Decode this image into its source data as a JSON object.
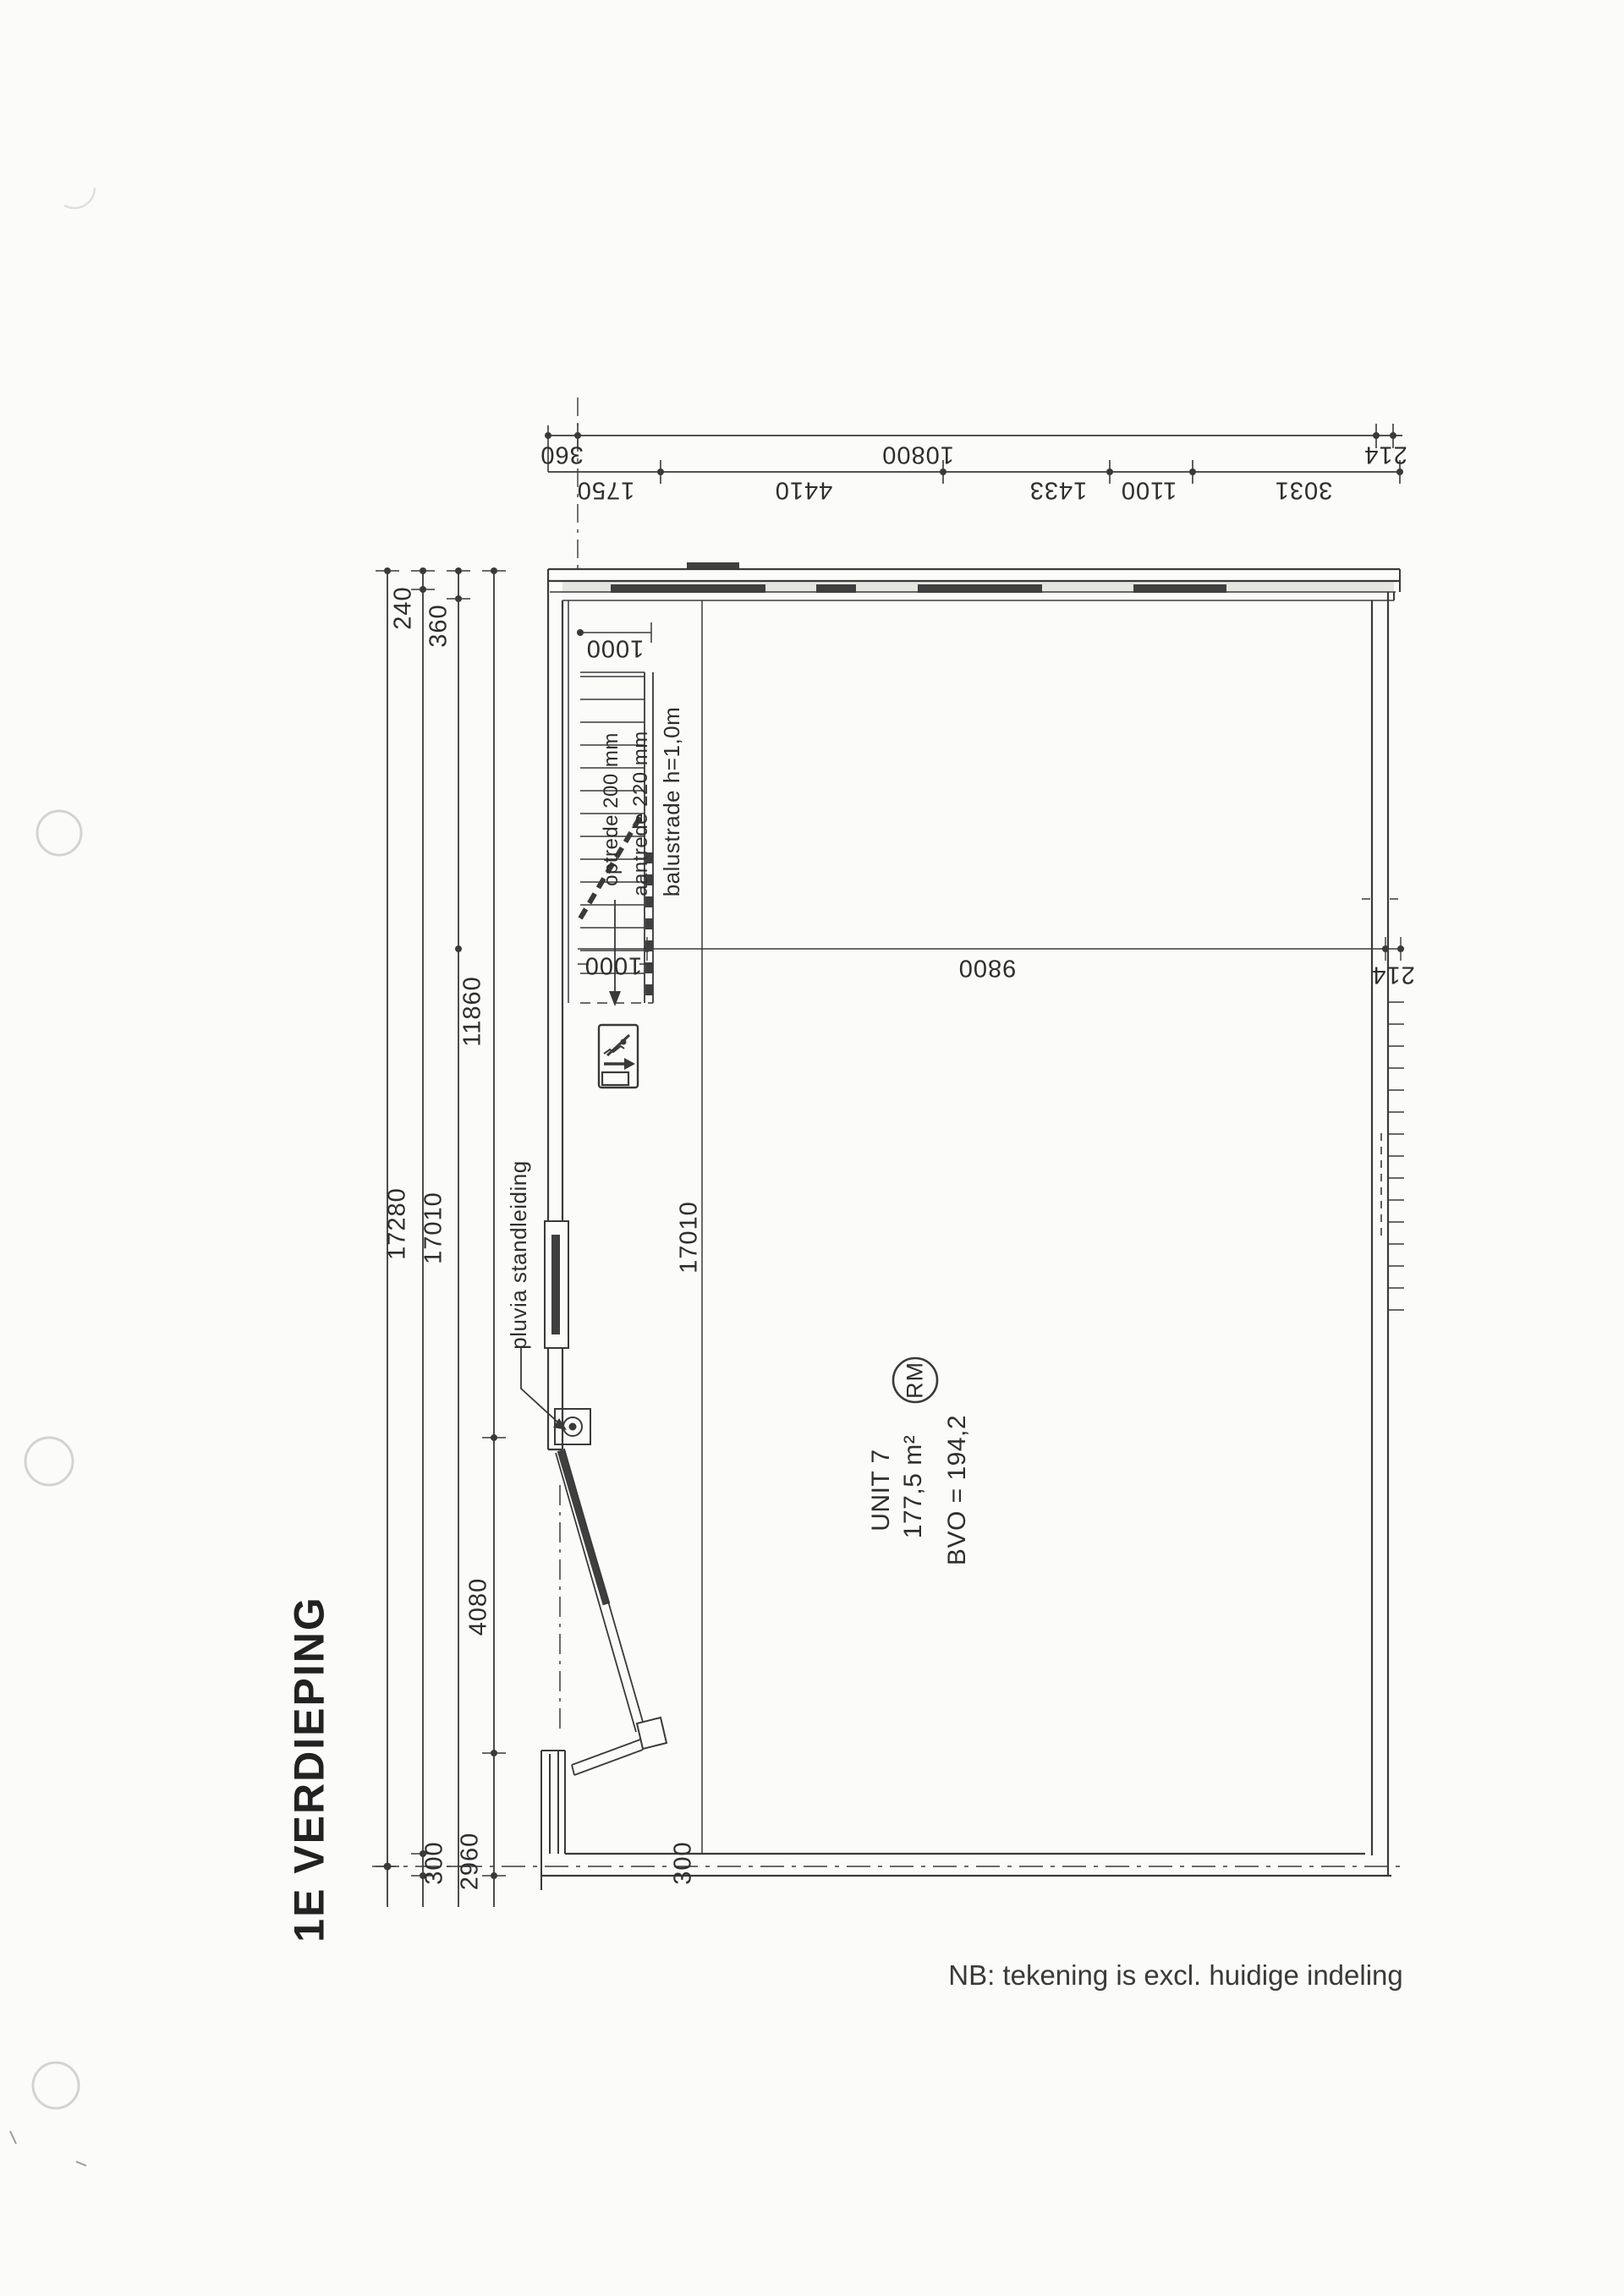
{
  "page": {
    "title": "1E VERDIEPING",
    "note": "NB: tekening is excl. huidige indeling"
  },
  "unit": {
    "name": "UNIT 7",
    "area": "177,5 m²",
    "bvo": "BVO = 194,2",
    "badge": "RM"
  },
  "annotations": {
    "stair_riser": "optrede 200 mm",
    "stair_tread": "aantrede 220 mm",
    "balustrade": "balustrade h=1,0m",
    "pluvia": "pluvia standleiding"
  },
  "dims": {
    "top_outer": [
      "360",
      "10800",
      "214"
    ],
    "top_inner": [
      "1750",
      "4410",
      "1433",
      "1100",
      "3031"
    ],
    "left": {
      "d240": "240",
      "d360": "360",
      "d11860": "11860",
      "d17280": "17280",
      "d17010": "17010",
      "d4080": "4080",
      "d300": "300",
      "d2960": "2960"
    },
    "bottom": {
      "d300": "300"
    },
    "interior": {
      "stair_top": "1000",
      "stair_bottom": "1000",
      "d9800": "9800",
      "d214": "214",
      "d17010": "17010"
    }
  }
}
